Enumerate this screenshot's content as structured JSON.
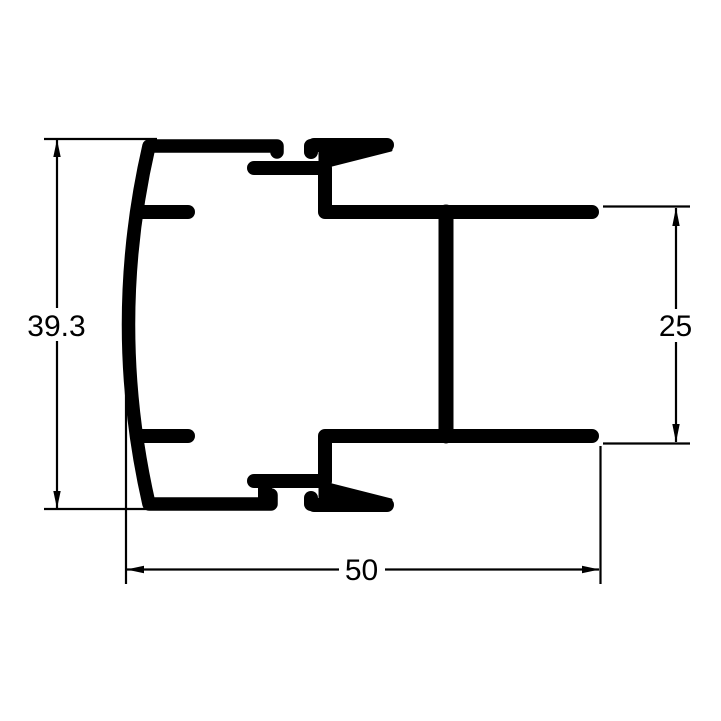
{
  "drawing": {
    "background_color": "#ffffff",
    "line_color": "#000000",
    "dimensions": {
      "overall_height": {
        "value": "39.3",
        "orientation": "vertical",
        "side": "left"
      },
      "channel_height": {
        "value": "25",
        "orientation": "vertical",
        "side": "right"
      },
      "overall_width": {
        "value": "50",
        "orientation": "horizontal",
        "side": "bottom"
      }
    }
  }
}
